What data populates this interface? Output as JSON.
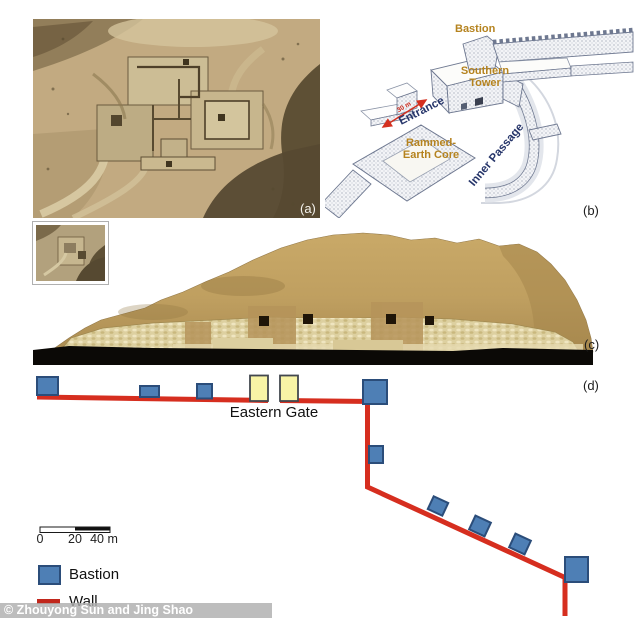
{
  "figure": {
    "credit": "© Zhouyong Sun and Jing Shao",
    "colors": {
      "bastion_fill": "#4e7fb5",
      "bastion_border": "#2b4d7a",
      "wall_red": "#d62e1f",
      "gate_yellow": "#f8f4a6",
      "diagram_label_orange": "#b5831f",
      "diagram_label_navy": "#26356a",
      "arrow_red": "#d43020"
    },
    "panels": {
      "a": {
        "label": "(a)"
      },
      "b": {
        "label": "(b)",
        "bastion": "Bastion",
        "southern_tower_line1": "Southern",
        "southern_tower_line2": "Tower",
        "entrance": "Entrance",
        "entrance_span": "30 m",
        "core_line1": "Rammed-",
        "core_line2": "Earth Core",
        "inner_passage": "Inner Passage"
      },
      "c": {
        "label": "(c)"
      },
      "d": {
        "label": "(d)",
        "gate": "Eastern Gate",
        "scale_ticks": {
          "t0": "0",
          "t1": "20",
          "t2": "40 m"
        },
        "legend": {
          "bastion": "Bastion",
          "wall": "Wall"
        }
      }
    }
  }
}
